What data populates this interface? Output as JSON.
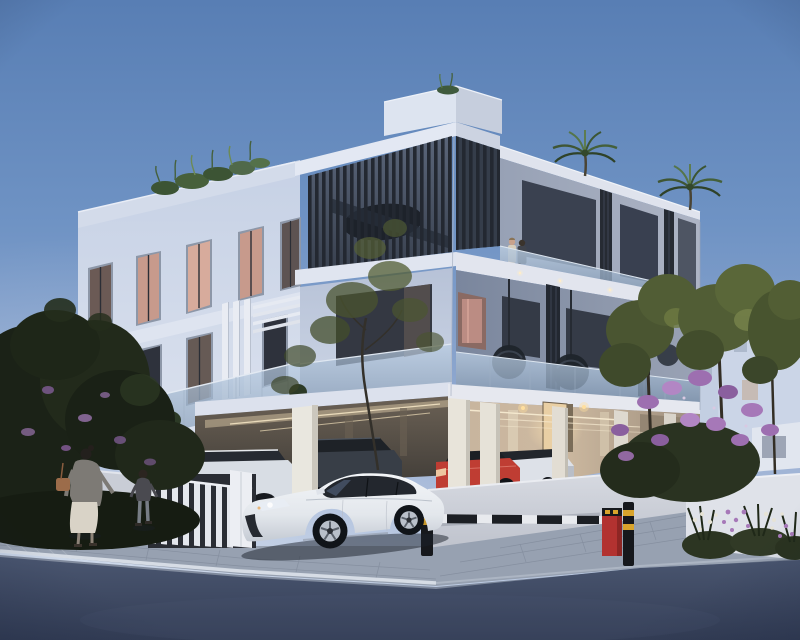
{
  "meta": {
    "kind": "photoreal architectural rendering",
    "time_of_day": "dusk",
    "description": "Three-storey modern white apartment building with rooftop greenery, dark slatted balcony screens, open ground-floor parking holding five cars, a white Porsche saloon parked on the forecourt, a woman and child walking past on the pavement, flowering landscaping, and a red parking barrier with a black-and-white boom arm."
  },
  "palette": {
    "sky_top": "#587eb4",
    "sky_mid": "#8da6cd",
    "sky_horizon": "#c6d2e6",
    "facade_light": "#dbe2ef",
    "facade_shadow": "#c6d1e5",
    "fascia_white": "#e2e6f0",
    "slat_dark": "#232831",
    "glass_blue": "#9db3cd",
    "window_dark": "#343a46",
    "window_warm": "#d0a394",
    "garage_warm": "#c7b49e",
    "door_glow": "#e9cfa4",
    "porsche_white": "#eef1f5",
    "wagon_white": "#d8dde4",
    "suv_dark": "#383e47",
    "macan_red": "#bf3d33",
    "evoque_white": "#dde1e8",
    "suv_far_white": "#dfe2e7",
    "barrier_red": "#b23230",
    "bollard_black": "#16181c",
    "bollard_yellow": "#d9a42c",
    "arm_white": "#e8eaee",
    "arm_black": "#1c1f24",
    "wall_white": "#c9cdd6",
    "fence_white": "#e4e7ed",
    "planter_white": "#dfe2e9",
    "sidewalk": "#97a1b1",
    "road_dark": "#3d4962",
    "curb_line": "#d9dfe8",
    "foliage_dark": "#1b2217",
    "foliage_olive": "#515d35",
    "bougainvillea": "#9d6fb0",
    "flower_white": "#e6e3d6",
    "skin": "#c9a28c",
    "cardigan_grey": "#7d7a75",
    "dress_cream": "#d9d3c7",
    "bag_tan": "#9c6c4a",
    "child_top": "#4a4a50"
  },
  "scene": {
    "building": {
      "storeys": 3,
      "corner_balcony_screen": "dark vertical timber slats",
      "roof_planting": [
        "grasses over left parapet",
        "palm on near roof terrace",
        "palm on far roof terrace"
      ],
      "balcony_furniture": [
        "hanging egg chair",
        "hanging egg chair",
        "hanging egg chair"
      ],
      "garage": {
        "type": "open undercroft parking",
        "lighting": "warm linear ceiling lights",
        "entrance": "lit lobby door"
      }
    },
    "vehicles": [
      {
        "label": "white-porsche-saloon",
        "position": "parked on forecourt facing left"
      },
      {
        "label": "white-estate-car",
        "position": "garage left bay behind fence"
      },
      {
        "label": "dark-grey-suv",
        "position": "garage left bay"
      },
      {
        "label": "red-compact-suv",
        "position": "garage right bay"
      },
      {
        "label": "white-compact-suv",
        "position": "garage right bay"
      },
      {
        "label": "white-far-suv",
        "position": "garage far right bay"
      }
    ],
    "people": [
      {
        "label": "woman-walking",
        "detail": "grey cardigan, cream dress, tan shoulder bag"
      },
      {
        "label": "child-walking",
        "detail": "dark top, grey trousers"
      },
      {
        "label": "couple-on-balcony",
        "detail": "standing behind glass balustrade on upper floor"
      }
    ],
    "street": {
      "barrier": "red post with black-and-white boom arm",
      "bollards": 2,
      "kerb": "white painted kerb line",
      "surface": "dark asphalt",
      "footway": "light stone paving"
    },
    "landscaping": [
      "dark trees left",
      "purple bougainvillea",
      "white flower bed",
      "olive trees right",
      "background white buildings"
    ]
  }
}
